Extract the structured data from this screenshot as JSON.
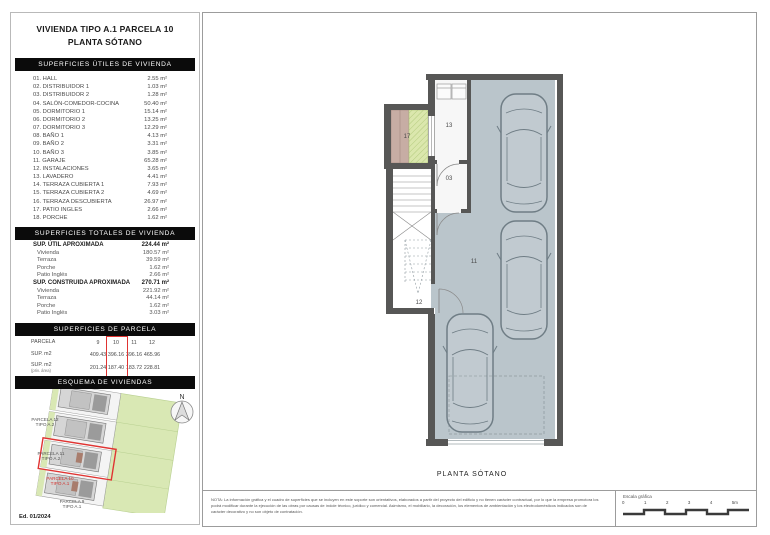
{
  "title": {
    "line1": "VIVIENDA TIPO A.1 PARCELA 10",
    "line2": "PLANTA SÓTANO"
  },
  "sections": {
    "utiles": {
      "header": "SUPERFICIES ÚTILES DE VIVIENDA",
      "rows": [
        {
          "label": "01. HALL",
          "value": "2.55 m²"
        },
        {
          "label": "02. DISTRIBUIDOR 1",
          "value": "1.03 m²"
        },
        {
          "label": "03. DISTRIBUIDOR 2",
          "value": "1.28 m²"
        },
        {
          "label": "04. SALÓN-COMEDOR-COCINA",
          "value": "50.40 m²"
        },
        {
          "label": "05. DORMITORIO 1",
          "value": "15.14 m²"
        },
        {
          "label": "06. DORMITORIO 2",
          "value": "13.25 m²"
        },
        {
          "label": "07. DORMITORIO 3",
          "value": "12.29 m²"
        },
        {
          "label": "08. BAÑO 1",
          "value": "4.13 m²"
        },
        {
          "label": "09. BAÑO 2",
          "value": "3.31 m²"
        },
        {
          "label": "10. BAÑO 3",
          "value": "3.85 m²"
        },
        {
          "label": "11. GARAJE",
          "value": "65.28 m²"
        },
        {
          "label": "12. INSTALACIONES",
          "value": "3.65 m²"
        },
        {
          "label": "13. LAVADERO",
          "value": "4.41 m²"
        },
        {
          "label": "14. TERRAZA CUBIERTA 1",
          "value": "7.93 m²"
        },
        {
          "label": "15. TERRAZA CUBIERTA 2",
          "value": "4.69 m²"
        },
        {
          "label": "16. TERRAZA DESCUBIERTA",
          "value": "26.97 m²"
        },
        {
          "label": "17. PATIO INGLES",
          "value": "2.66 m²"
        },
        {
          "label": "18. PORCHE",
          "value": "1.62 m²"
        }
      ]
    },
    "totales": {
      "header": "SUPERFICIES TOTALES DE VIVIENDA",
      "groups": [
        {
          "label": "SUP. ÚTIL APROXIMADA",
          "value": "224.44 m²",
          "items": [
            {
              "label": "Vivienda",
              "value": "180.57 m²"
            },
            {
              "label": "Terraza",
              "value": "39.59 m²"
            },
            {
              "label": "Porche",
              "value": "1.62 m²"
            },
            {
              "label": "Patio Inglés",
              "value": "2.66 m²"
            }
          ]
        },
        {
          "label": "SUP. CONSTRUIDA APROXIMADA",
          "value": "270.71 m²",
          "items": [
            {
              "label": "Vivienda",
              "value": "221.92 m²"
            },
            {
              "label": "Terraza",
              "value": "44.14 m²"
            },
            {
              "label": "Porche",
              "value": "1.62 m²"
            },
            {
              "label": "Patio Inglés",
              "value": "3.03 m²"
            }
          ]
        }
      ]
    },
    "parcela": {
      "header": "SUPERFICIES DE PARCELA",
      "head": {
        "label": "PARCELA",
        "c1": "9",
        "c2": "10",
        "c3": "11",
        "c4": "12"
      },
      "rows": [
        {
          "label": "SUP. m2",
          "sub": "",
          "c1": "409.43",
          "c2": "396.16",
          "c3": "396.16",
          "c4": "465.96"
        },
        {
          "label": "SUP. m2",
          "sub": "(priv. área)",
          "c1": "201.24",
          "c2": "187.40",
          "c3": "183.72",
          "c4": "228.81"
        }
      ],
      "highlighted_column": "10"
    },
    "esquema": {
      "header": "ESQUEMA DE VIVIENDAS",
      "labels": [
        {
          "l1": "PARCELA 12",
          "l2": "TIPO A.2"
        },
        {
          "l1": "PARCELA 11",
          "l2": "TIPO A.2"
        },
        {
          "l1": "PARCELA 10",
          "l2": "TIPO A.1"
        },
        {
          "l1": "PARCELA 9",
          "l2": "TIPO A.1"
        }
      ],
      "north": "N",
      "edition": "Ed. 01/2024"
    }
  },
  "plan": {
    "caption": "PLANTA SÓTANO",
    "rooms": [
      "17",
      "13",
      "03",
      "11",
      "12"
    ]
  },
  "footer": {
    "note": "NOTA: La información gráfica y el cuadro de superficies que se incluyen en este soporte son orientativos, elaborados a partir del proyecto del edificio y no tienen carácter contractual, por lo que la empresa promotora los podrá modificar durante la ejecución de las obras por causas de índole técnico, jurídico y comercial. Asimismo, el mobiliario, la decoración, los elementos de ambientación y los electrodomésticos indicados son de carácter decorativo y no son objeto de contratación.",
    "scale_label": "Escala gráfica",
    "ticks": [
      "0",
      "1",
      "2",
      "3",
      "4",
      "5m"
    ]
  },
  "colors": {
    "wall": "#575756",
    "floor": "#bac5cb",
    "green": "#d9e8b4",
    "tan": "#c7ada4",
    "highlight_red": "#e03432",
    "bar_black": "#0b0b0b"
  }
}
